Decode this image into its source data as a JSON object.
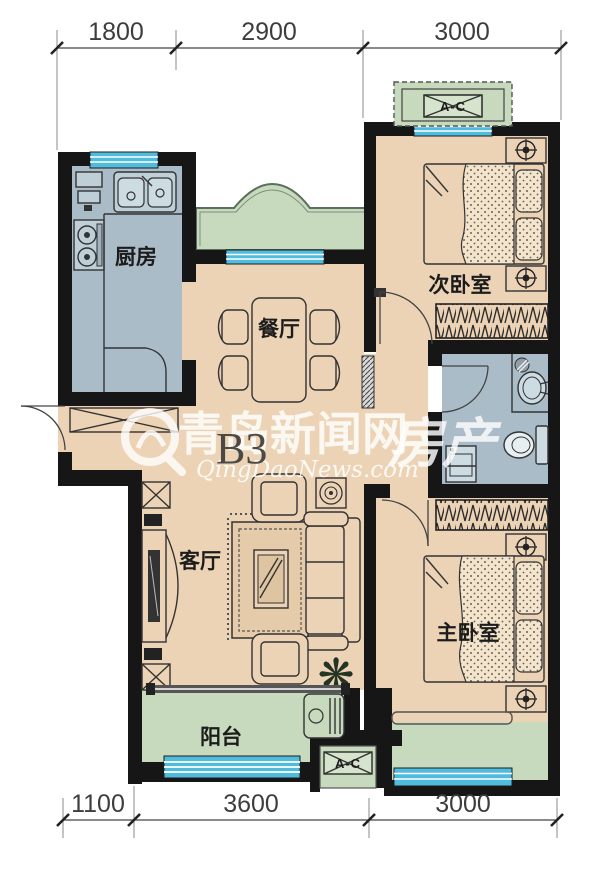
{
  "unit_label": "B3",
  "watermark": {
    "logo_glyph": "Q",
    "site_name": "青岛新闻网",
    "site_url": "QingDaoNews.com",
    "section": "房产"
  },
  "rooms": {
    "kitchen": {
      "label": "厨房"
    },
    "dining": {
      "label": "餐厅"
    },
    "bedroom2": {
      "label": "次卧室"
    },
    "living": {
      "label": "客厅"
    },
    "master": {
      "label": "主卧室"
    },
    "balcony": {
      "label": "阳台"
    }
  },
  "ac_units": {
    "top": "A-C",
    "bottom": "A-C"
  },
  "dimensions": {
    "top": [
      {
        "value": "1800"
      },
      {
        "value": "2900"
      },
      {
        "value": "3000"
      }
    ],
    "bottom": [
      {
        "value": "1100"
      },
      {
        "value": "3600"
      },
      {
        "value": "3000"
      }
    ]
  },
  "icons": {
    "plant_glyph": "❋"
  },
  "colors": {
    "wall": "#161616",
    "room_tan": "#ecd3b5",
    "room_bluegray": "#a9bcc8",
    "green": "#c7dabd",
    "window_blue": "#4fbcde",
    "dim_text": "#3d3d3d",
    "watermark_white": "#ffffff"
  }
}
